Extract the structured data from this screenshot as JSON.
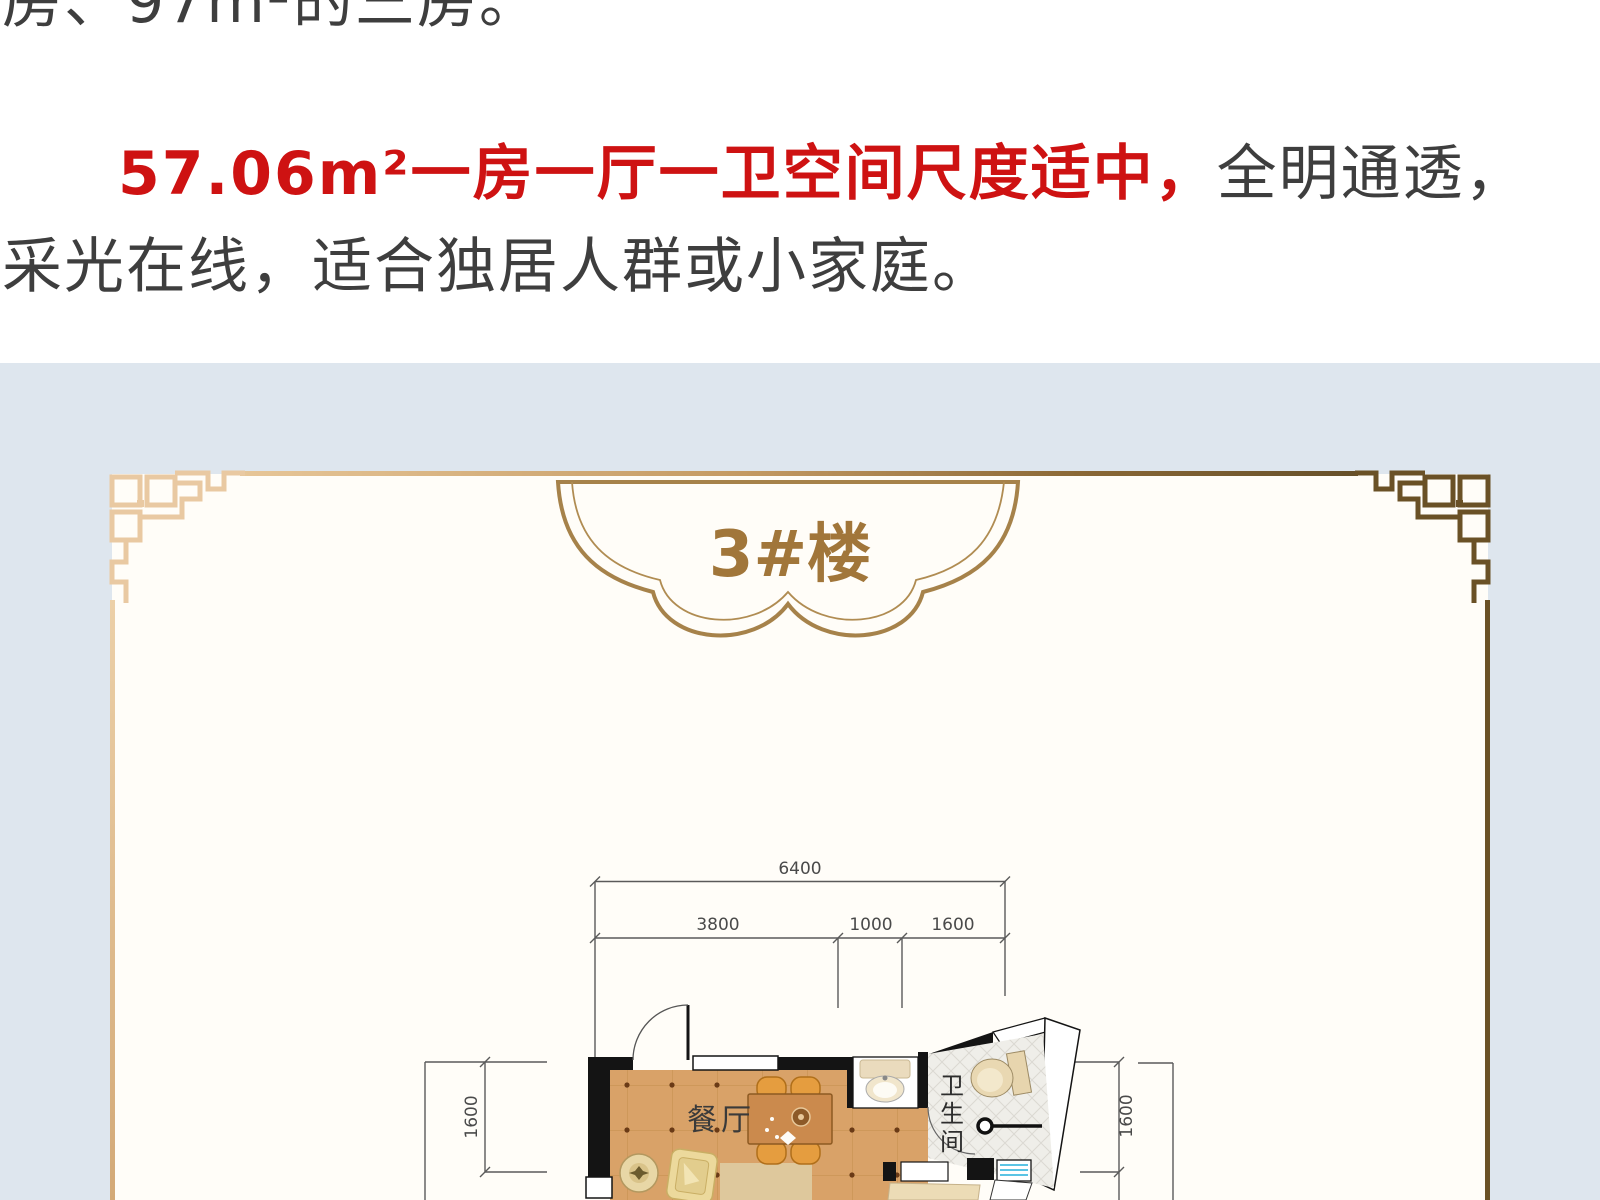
{
  "article": {
    "intro_line": "房、97m²的三房。",
    "highlight": "57.06m²一房一厅一卫空间尺度适中，",
    "body_1": "全明通透，",
    "body_2": "采光在线，适合独居人群或小家庭。"
  },
  "banner": {
    "building_label": "3#楼"
  },
  "floor_plan": {
    "dim_total_width": "6400",
    "dim_segments": [
      "3800",
      "1000",
      "1600"
    ],
    "dim_left_height": "1600",
    "dim_right_height": "1600",
    "room_dining": "餐厅",
    "bathroom_chars": [
      "卫",
      "生",
      "间"
    ]
  },
  "colors": {
    "accent_red": "#ce1212",
    "text_gray": "#3e3e3e",
    "panel_blue": "#dee6ee",
    "card_cream": "#fffdf8",
    "gold_light": "#e9c9a2",
    "gold_dark": "#6a5126",
    "banner_outline": "#a6824a",
    "banner_text": "#a1763a",
    "floor_tan": "#d9a268",
    "wall_black": "#141414",
    "window_blue": "#5bc4e4"
  }
}
